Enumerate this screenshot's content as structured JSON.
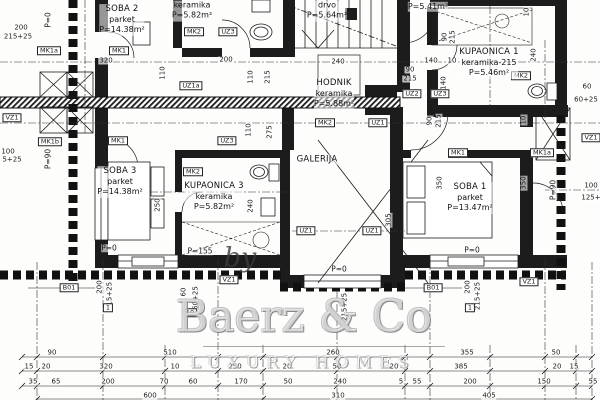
{
  "colors": {
    "ink": "#1a1a1a",
    "paper": "#fdfdfc",
    "watermark_gray": "#8a8a8a"
  },
  "watermark": {
    "by": "by",
    "brand": "Baerz & Co",
    "tagline": "LUXURY HOMES"
  },
  "rooms": [
    {
      "name": "SOBA 2",
      "floor": "parket",
      "area": "P=14.38m²",
      "x": 122,
      "y": 20
    },
    {
      "name": null,
      "floor": "keramika",
      "area": "P=5.82m²",
      "x": 192,
      "y": 11
    },
    {
      "name": null,
      "floor": "drvo",
      "area": "P=5.64m²",
      "x": 327,
      "y": 11
    },
    {
      "name": null,
      "floor": null,
      "area": "P=5.41m²",
      "x": 428,
      "y": 7
    },
    {
      "name": "KUPAONICA 1",
      "floor": "keramika-215",
      "area": "P=5.46m²",
      "x": 489,
      "y": 63
    },
    {
      "name": "HODNIK",
      "floor": "keramika",
      "area": "P=5.88m²",
      "x": 334,
      "y": 94
    },
    {
      "name": "SOBA 3",
      "floor": "parket",
      "area": "P=14.38m²",
      "x": 120,
      "y": 182
    },
    {
      "name": "KUPAONICA 3",
      "floor": "keramika",
      "area": "P=5.82m²",
      "x": 214,
      "y": 197
    },
    {
      "name": "GALERIJA",
      "floor": null,
      "area": null,
      "x": 317,
      "y": 160
    },
    {
      "name": "SOBA 1",
      "floor": "parket",
      "area": "P=13.47m²",
      "x": 470,
      "y": 198
    }
  ],
  "levels": [
    {
      "t": "P=0",
      "x": 48,
      "y": 20,
      "r": 1
    },
    {
      "t": "P=90",
      "x": 48,
      "y": 159,
      "r": 1
    },
    {
      "t": "P=0",
      "x": 109,
      "y": 248
    },
    {
      "t": "P=155",
      "x": 200,
      "y": 251
    },
    {
      "t": "P=0",
      "x": 339,
      "y": 269
    },
    {
      "t": "P=0",
      "x": 472,
      "y": 250
    },
    {
      "t": "P=90",
      "x": 553,
      "y": 190,
      "r": 1
    }
  ],
  "tags": [
    {
      "t": "MK1a",
      "x": 49,
      "y": 51
    },
    {
      "t": "MK1",
      "x": 119,
      "y": 51
    },
    {
      "t": "MK2",
      "x": 194,
      "y": 32
    },
    {
      "t": "UZ3",
      "x": 228,
      "y": 32
    },
    {
      "t": "UZ1a",
      "x": 191,
      "y": 86
    },
    {
      "t": "VZ1",
      "x": 12,
      "y": 118
    },
    {
      "t": "MK1b",
      "x": 50,
      "y": 142
    },
    {
      "t": "MK1",
      "x": 118,
      "y": 141
    },
    {
      "t": "UZ3",
      "x": 227,
      "y": 141
    },
    {
      "t": "MK2",
      "x": 193,
      "y": 172
    },
    {
      "t": "MK2",
      "x": 325,
      "y": 123
    },
    {
      "t": "UZ1",
      "x": 378,
      "y": 123
    },
    {
      "t": "UZ2",
      "x": 412,
      "y": 94
    },
    {
      "t": "UZ3",
      "x": 440,
      "y": 94
    },
    {
      "t": "MK2",
      "x": 521,
      "y": 76
    },
    {
      "t": "MK1",
      "x": 458,
      "y": 153
    },
    {
      "t": "MK1a",
      "x": 542,
      "y": 153
    },
    {
      "t": "VZ1",
      "x": 591,
      "y": 138
    },
    {
      "t": "UZ1",
      "x": 306,
      "y": 231
    },
    {
      "t": "UZ1",
      "x": 372,
      "y": 231
    },
    {
      "t": "VZ1",
      "x": 229,
      "y": 280
    },
    {
      "t": "VZ1",
      "x": 529,
      "y": 282
    },
    {
      "t": "B01",
      "x": 69,
      "y": 288
    },
    {
      "t": "B01",
      "x": 433,
      "y": 288
    },
    {
      "t": "1",
      "x": 108,
      "y": 308
    },
    {
      "t": "1",
      "x": 470,
      "y": 308
    },
    {
      "t": "10",
      "x": 190,
      "y": 313
    }
  ],
  "dims": [
    {
      "t": "320",
      "x": 106,
      "y": 61
    },
    {
      "t": "110",
      "x": 163,
      "y": 73,
      "r": 1
    },
    {
      "t": "200",
      "x": 226,
      "y": 60
    },
    {
      "t": "110",
      "x": 251,
      "y": 77,
      "r": 1
    },
    {
      "t": "215",
      "x": 268,
      "y": 77,
      "r": 1
    },
    {
      "t": "90",
      "x": 410,
      "y": 70
    },
    {
      "t": "215",
      "x": 410,
      "y": 79
    },
    {
      "t": "140",
      "x": 431,
      "y": 61
    },
    {
      "t": "10",
      "x": 452,
      "y": 61
    },
    {
      "t": "140",
      "x": 444,
      "y": 83,
      "r": 1
    },
    {
      "t": "90",
      "x": 445,
      "y": 37,
      "r": 1
    },
    {
      "t": "215",
      "x": 453,
      "y": 37,
      "r": 1
    },
    {
      "t": "10",
      "x": 527,
      "y": 12,
      "r": 1
    },
    {
      "t": "240",
      "x": 534,
      "y": 55,
      "r": 1
    },
    {
      "t": "240",
      "x": 338,
      "y": 62
    },
    {
      "t": "90",
      "x": 430,
      "y": 121,
      "r": 1
    },
    {
      "t": "215",
      "x": 439,
      "y": 121,
      "r": 1
    },
    {
      "t": "110",
      "x": 249,
      "y": 130,
      "r": 1
    },
    {
      "t": "275",
      "x": 270,
      "y": 132,
      "r": 1
    },
    {
      "t": "250",
      "x": 158,
      "y": 205,
      "r": 1
    },
    {
      "t": "240",
      "x": 251,
      "y": 206,
      "r": 1
    },
    {
      "t": "305",
      "x": 389,
      "y": 220,
      "r": 1
    },
    {
      "t": "350",
      "x": 440,
      "y": 183,
      "r": 1
    },
    {
      "t": "350",
      "x": 524,
      "y": 183,
      "r": 1
    },
    {
      "t": "10",
      "x": 524,
      "y": 120,
      "r": 1
    },
    {
      "t": "200",
      "x": 21,
      "y": 28
    },
    {
      "t": "215+25",
      "x": 18,
      "y": 37
    },
    {
      "t": "100",
      "x": 8,
      "y": 152
    },
    {
      "t": "5+25",
      "x": 12,
      "y": 160
    },
    {
      "t": "60",
      "x": 587,
      "y": 87
    },
    {
      "t": "60+25",
      "x": 586,
      "y": 100
    },
    {
      "t": "100",
      "x": 591,
      "y": 186
    },
    {
      "t": "125+",
      "x": 591,
      "y": 198
    },
    {
      "t": "200",
      "x": 100,
      "y": 287,
      "r": 1
    },
    {
      "t": "215+25",
      "x": 110,
      "y": 296,
      "r": 1
    },
    {
      "t": "60",
      "x": 184,
      "y": 292,
      "r": 1
    },
    {
      "t": "60+25",
      "x": 196,
      "y": 298,
      "r": 1
    },
    {
      "t": "215+25",
      "x": 345,
      "y": 307,
      "r": 1
    },
    {
      "t": "200",
      "x": 468,
      "y": 287,
      "r": 1
    },
    {
      "t": "215+25",
      "x": 478,
      "y": 296,
      "r": 1
    },
    {
      "t": "90",
      "x": 52,
      "y": 353
    },
    {
      "t": "510",
      "x": 170,
      "y": 353
    },
    {
      "t": "260",
      "x": 333,
      "y": 353
    },
    {
      "t": "355",
      "x": 467,
      "y": 353
    },
    {
      "t": "50",
      "x": 556,
      "y": 353
    },
    {
      "t": "15",
      "x": 29,
      "y": 367
    },
    {
      "t": "20",
      "x": 46,
      "y": 367
    },
    {
      "t": "320",
      "x": 106,
      "y": 367
    },
    {
      "t": "10",
      "x": 175,
      "y": 367
    },
    {
      "t": "250",
      "x": 235,
      "y": 367
    },
    {
      "t": "20",
      "x": 287,
      "y": 367
    },
    {
      "t": "50",
      "x": 337,
      "y": 367
    },
    {
      "t": "20",
      "x": 394,
      "y": 367
    },
    {
      "t": "385",
      "x": 461,
      "y": 367
    },
    {
      "t": "20",
      "x": 557,
      "y": 367
    },
    {
      "t": "15",
      "x": 574,
      "y": 367
    },
    {
      "t": "35",
      "x": 33,
      "y": 382
    },
    {
      "t": "65",
      "x": 56,
      "y": 382
    },
    {
      "t": "200",
      "x": 108,
      "y": 382
    },
    {
      "t": "70",
      "x": 164,
      "y": 382
    },
    {
      "t": "60",
      "x": 193,
      "y": 382
    },
    {
      "t": "170",
      "x": 241,
      "y": 382
    },
    {
      "t": "50",
      "x": 288,
      "y": 382
    },
    {
      "t": "240",
      "x": 340,
      "y": 382
    },
    {
      "t": "5",
      "x": 401,
      "y": 382
    },
    {
      "t": "55",
      "x": 417,
      "y": 382
    },
    {
      "t": "200",
      "x": 470,
      "y": 382
    },
    {
      "t": "150",
      "x": 544,
      "y": 382
    },
    {
      "t": "55",
      "x": 593,
      "y": 382
    },
    {
      "t": "600",
      "x": 150,
      "y": 396
    },
    {
      "t": "310",
      "x": 338,
      "y": 396
    },
    {
      "t": "405",
      "x": 489,
      "y": 396
    }
  ]
}
